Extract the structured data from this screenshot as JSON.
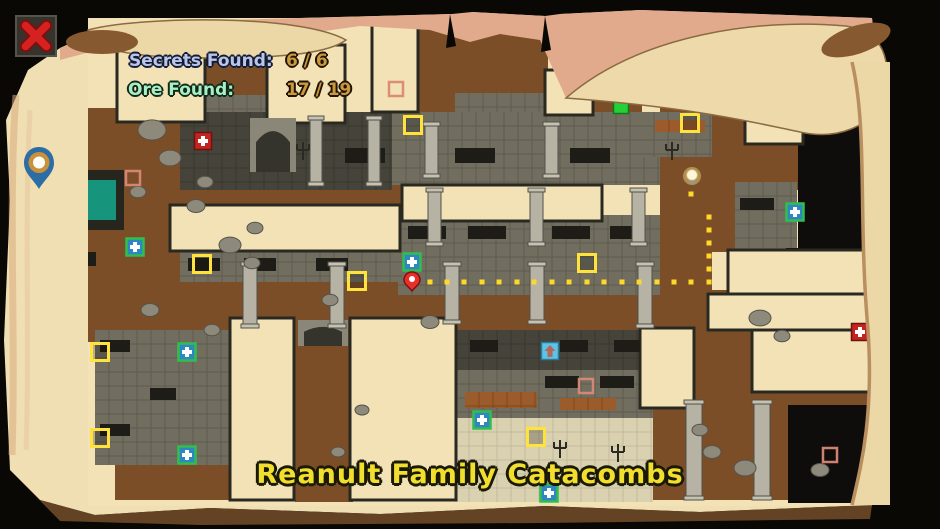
{
  "window": {
    "close_icon": "x-close"
  },
  "header": {
    "secrets_label": "Secrets Found:",
    "secrets_value": "6 / 6",
    "ore_label": "Ore Found:",
    "ore_value": "17 / 19"
  },
  "title": "Reanult Family Catacombs",
  "colors": {
    "parchment": "#f2e2b6",
    "dirt": "#7c4e28",
    "stone": "#716e60",
    "stone_dark": "#45433a",
    "cave": "#0e0d0b",
    "pale": "#dad1b0",
    "wall": "#26251e",
    "pool": "#17947c",
    "room_stroke": "#2a2921",
    "slot": "#1d1c16",
    "brick": "#9c5b2b",
    "column": "#b7b3a4",
    "rock": "#8d8a7c",
    "yellow_marker": "#ffe23c",
    "green_marker": "#2fbf4e",
    "green_marker_fill": "#2f86c0",
    "red_marker": "#c32420",
    "ore_marker": "#d98876",
    "exit_marker": "#25cf38",
    "stairs_fill": "#5ec4e6",
    "stairs_arrow": "#b4685a",
    "path_dot": "#ffd92a",
    "player": "#e8302a",
    "bulb": "#fdf6d8"
  },
  "map": {
    "regions": [
      {
        "k": "dirt",
        "r": [
          205,
          22,
          62,
          78
        ]
      },
      {
        "k": "dirt",
        "r": [
          418,
          22,
          130,
          100
        ]
      },
      {
        "k": "dirt",
        "r": [
          592,
          22,
          50,
          95
        ]
      },
      {
        "k": "dirt",
        "r": [
          640,
          22,
          175,
          72
        ]
      },
      {
        "k": "dirt",
        "r": [
          706,
          90,
          110,
          100
        ]
      },
      {
        "k": "dirt",
        "r": [
          85,
          108,
          100,
          125
        ]
      },
      {
        "k": "dirt",
        "r": [
          118,
          182,
          315,
          108
        ]
      },
      {
        "k": "dirt",
        "r": [
          85,
          230,
          350,
          112
        ]
      },
      {
        "k": "dirt",
        "r": [
          400,
          290,
          335,
          52
        ]
      },
      {
        "k": "dirt",
        "r": [
          660,
          108,
          52,
          195
        ]
      },
      {
        "k": "dirt",
        "r": [
          640,
          296,
          232,
          204
        ]
      },
      {
        "k": "dirt",
        "r": [
          295,
          338,
          58,
          164
        ]
      },
      {
        "k": "dirt",
        "r": [
          712,
          182,
          62,
          70
        ]
      },
      {
        "k": "dirt",
        "r": [
          115,
          460,
          230,
          40
        ]
      },
      {
        "k": "stone",
        "r": [
          205,
          95,
          62,
          30
        ],
        "g": 1
      },
      {
        "k": "stone",
        "r": [
          455,
          93,
          90,
          24
        ],
        "g": 1
      },
      {
        "k": "stone",
        "r": [
          392,
          112,
          268,
          73
        ],
        "g": 1
      },
      {
        "k": "stone",
        "r": [
          640,
          112,
          72,
          45
        ],
        "g": 1
      },
      {
        "k": "stone",
        "r": [
          398,
          215,
          262,
          80
        ],
        "g": 1
      },
      {
        "k": "stone",
        "r": [
          180,
          248,
          222,
          34
        ],
        "g": 1
      },
      {
        "k": "stone",
        "r": [
          95,
          330,
          138,
          135
        ],
        "g": 1
      },
      {
        "k": "stone",
        "r": [
          735,
          182,
          62,
          68
        ],
        "g": 1
      },
      {
        "k": "stone",
        "r": [
          455,
          370,
          198,
          48
        ],
        "g": 1
      },
      {
        "k": "stone_dark",
        "r": [
          180,
          112,
          212,
          78
        ],
        "g": 1
      },
      {
        "k": "stone_dark",
        "r": [
          455,
          330,
          198,
          40
        ],
        "g": 1
      },
      {
        "k": "cave",
        "r": [
          798,
          126,
          66,
          130
        ]
      },
      {
        "k": "cave",
        "r": [
          786,
          248,
          86,
          88
        ]
      },
      {
        "k": "cave",
        "r": [
          788,
          405,
          82,
          98
        ]
      },
      {
        "k": "pale",
        "r": [
          455,
          418,
          198,
          84
        ],
        "g": 1
      },
      {
        "k": "wall",
        "r": [
          58,
          170,
          66,
          60
        ]
      },
      {
        "k": "pool",
        "r": [
          66,
          180,
          50,
          40
        ]
      }
    ],
    "rooms": [
      [
        117,
        40,
        88,
        82
      ],
      [
        267,
        45,
        78,
        78
      ],
      [
        372,
        22,
        46,
        90
      ],
      [
        545,
        70,
        48,
        45
      ],
      [
        745,
        116,
        58,
        28
      ],
      [
        170,
        205,
        230,
        46
      ],
      [
        402,
        185,
        200,
        36
      ],
      [
        230,
        318,
        64,
        182
      ],
      [
        350,
        318,
        106,
        182
      ],
      [
        728,
        250,
        142,
        50
      ],
      [
        708,
        294,
        164,
        36
      ],
      [
        752,
        330,
        120,
        62
      ],
      [
        640,
        328,
        54,
        80
      ]
    ],
    "arches": [
      {
        "x": 250,
        "y": 118,
        "w": 46,
        "h": 54
      },
      {
        "x": 298,
        "y": 320,
        "w": 50,
        "h": 26
      }
    ],
    "slots": [
      [
        408,
        226,
        38,
        13
      ],
      [
        468,
        226,
        38,
        13
      ],
      [
        552,
        226,
        38,
        13
      ],
      [
        610,
        226,
        28,
        13
      ],
      [
        188,
        258,
        32,
        13
      ],
      [
        244,
        258,
        32,
        13
      ],
      [
        316,
        258,
        32,
        13
      ],
      [
        345,
        148,
        40,
        15
      ],
      [
        455,
        148,
        40,
        15
      ],
      [
        570,
        148,
        40,
        15
      ],
      [
        100,
        340,
        30,
        12
      ],
      [
        100,
        424,
        30,
        12
      ],
      [
        150,
        388,
        26,
        12
      ],
      [
        470,
        340,
        28,
        12
      ],
      [
        560,
        340,
        28,
        12
      ],
      [
        614,
        340,
        26,
        12
      ],
      [
        545,
        376,
        34,
        12
      ],
      [
        600,
        376,
        34,
        12
      ],
      [
        740,
        198,
        34,
        12
      ],
      [
        62,
        252,
        34,
        14
      ]
    ],
    "bricks": [
      [
        465,
        392,
        72,
        16
      ],
      [
        560,
        398,
        56,
        12
      ],
      [
        655,
        120,
        50,
        12
      ]
    ],
    "columns": [
      [
        310,
        116,
        12,
        70
      ],
      [
        368,
        116,
        12,
        70
      ],
      [
        425,
        122,
        13,
        56
      ],
      [
        545,
        122,
        13,
        56
      ],
      [
        428,
        188,
        13,
        58
      ],
      [
        530,
        188,
        13,
        58
      ],
      [
        632,
        188,
        13,
        58
      ],
      [
        243,
        262,
        14,
        66
      ],
      [
        330,
        262,
        14,
        66
      ],
      [
        445,
        262,
        14,
        62
      ],
      [
        530,
        262,
        14,
        62
      ],
      [
        638,
        262,
        14,
        66
      ],
      [
        686,
        400,
        16,
        100
      ],
      [
        754,
        400,
        16,
        100
      ]
    ],
    "rocks": [
      [
        152,
        130,
        14
      ],
      [
        170,
        158,
        11
      ],
      [
        196,
        206,
        9
      ],
      [
        230,
        245,
        11
      ],
      [
        252,
        263,
        8
      ],
      [
        150,
        310,
        9
      ],
      [
        212,
        330,
        8
      ],
      [
        138,
        192,
        8
      ],
      [
        330,
        300,
        8
      ],
      [
        430,
        322,
        9
      ],
      [
        760,
        318,
        11
      ],
      [
        782,
        336,
        8
      ],
      [
        712,
        452,
        9
      ],
      [
        745,
        468,
        11
      ],
      [
        700,
        430,
        8
      ],
      [
        820,
        470,
        9
      ],
      [
        362,
        410,
        7
      ],
      [
        338,
        452,
        7
      ],
      [
        255,
        228,
        8
      ],
      [
        205,
        182,
        8
      ]
    ],
    "candles": [
      [
        303,
        150
      ],
      [
        672,
        150
      ],
      [
        560,
        448
      ],
      [
        618,
        452
      ]
    ],
    "markers": {
      "yellow_squares": [
        [
          413,
          125
        ],
        [
          690,
          123
        ],
        [
          202,
          264
        ],
        [
          357,
          281
        ],
        [
          587,
          263
        ],
        [
          100,
          352
        ],
        [
          100,
          438
        ],
        [
          536,
          437
        ]
      ],
      "green_plus": [
        [
          135,
          247
        ],
        [
          412,
          262
        ],
        [
          795,
          212
        ],
        [
          187,
          352
        ],
        [
          187,
          455
        ],
        [
          482,
          420
        ],
        [
          549,
          493
        ]
      ],
      "red_plus": [
        [
          203,
          141
        ],
        [
          860,
          332
        ]
      ],
      "ore_squares": [
        [
          396,
          89
        ],
        [
          133,
          178
        ],
        [
          586,
          386
        ],
        [
          830,
          455
        ]
      ],
      "exit_square": [
        621,
        106
      ],
      "stairs_up": [
        550,
        351
      ],
      "bulb": [
        692,
        176
      ],
      "player": [
        412,
        281
      ]
    },
    "path_dots": [
      [
        430,
        282
      ],
      [
        447,
        282
      ],
      [
        464,
        282
      ],
      [
        482,
        282
      ],
      [
        499,
        282
      ],
      [
        517,
        282
      ],
      [
        534,
        282
      ],
      [
        552,
        282
      ],
      [
        569,
        282
      ],
      [
        587,
        282
      ],
      [
        604,
        282
      ],
      [
        622,
        282
      ],
      [
        639,
        282
      ],
      [
        657,
        282
      ],
      [
        674,
        282
      ],
      [
        691,
        282
      ],
      [
        709,
        282
      ],
      [
        709,
        269
      ],
      [
        709,
        256
      ],
      [
        709,
        243
      ],
      [
        709,
        230
      ],
      [
        709,
        217
      ],
      [
        691,
        194
      ]
    ]
  }
}
